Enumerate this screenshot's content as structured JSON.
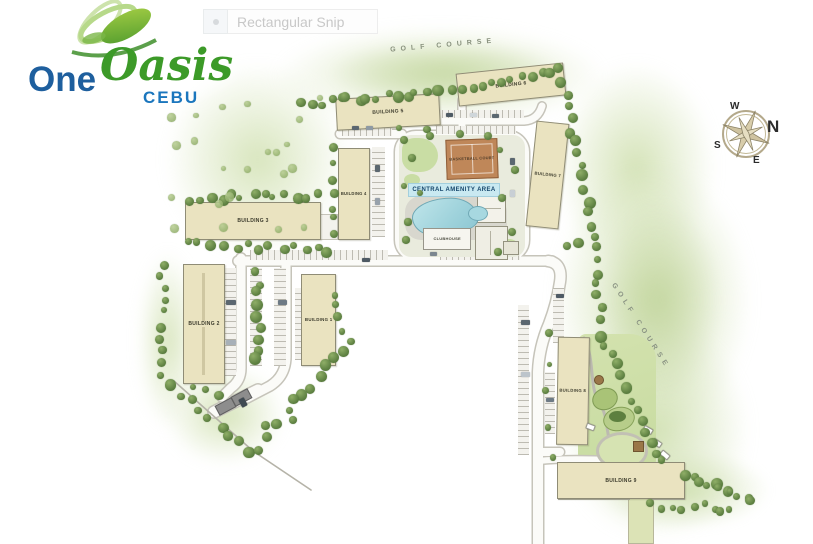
{
  "snip_tool": {
    "label": "Rectangular Snip"
  },
  "logo": {
    "word_one": "One",
    "word_oasis": "Oasis",
    "subtitle": "CEBU"
  },
  "site_plan": {
    "golf_top_label": "GOLF COURSE",
    "golf_right_label": "GOLF COURSE",
    "buildings": [
      {
        "label": "BUILDING 1"
      },
      {
        "label": "BUILDING 2"
      },
      {
        "label": "BUILDING 3"
      },
      {
        "label": "BUILDING 4"
      },
      {
        "label": "BUILDING 5"
      },
      {
        "label": "BUILDING 6"
      },
      {
        "label": "BUILDING 7"
      },
      {
        "label": "BUILDING 8"
      },
      {
        "label": "BUILDING 9"
      }
    ],
    "amenities": {
      "basketball_court": "BASKETBALL COURT",
      "central_amenity_area": "CENTRAL AMENITY AREA",
      "clubhouse": "CLUBHOUSE"
    },
    "compass": {
      "north": "N",
      "south": "S",
      "east": "E",
      "west": "W"
    },
    "colors": {
      "building_fill": "#eae3c0",
      "tree_green": "#6d9150",
      "golf_wash": "#d7e4bf",
      "pool_blue": "#9ed2db",
      "court_orange": "#bf8759",
      "amenity_band_blue": "#c9e9f1",
      "logo_blue": "#1e5f9e",
      "logo_green": "#3c9a28"
    }
  }
}
